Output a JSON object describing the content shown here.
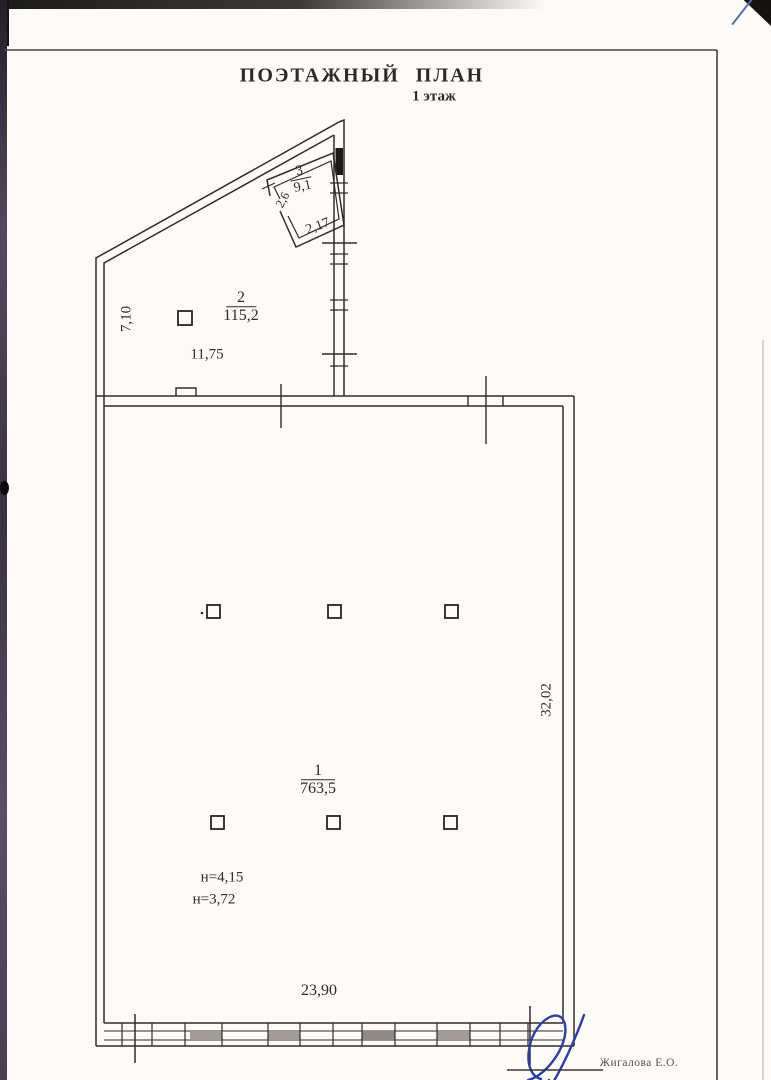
{
  "page": {
    "title": "ПОЭТАЖНЫЙ ПЛАН",
    "subtitle": "1 этаж"
  },
  "plan": {
    "room1": {
      "number": "1",
      "area": "763,5",
      "height_line1": "н=4,15",
      "height_line2": "н=3,72",
      "dim_right": "32,02",
      "dim_bottom": "23,90"
    },
    "room2": {
      "number": "2",
      "area": "115,2",
      "dim_left": "7,10",
      "dim_bottom": "11,75"
    },
    "room3": {
      "number": "3",
      "area": "9,1",
      "dim_side": "2,6",
      "dim_bottom": "2,17"
    }
  },
  "footer": {
    "examiner_name": "Жигалова Е.О."
  },
  "colors": {
    "ink": "#2e2b27",
    "paper": "#fcfbf8",
    "signature_blue": "#2e3f9f"
  }
}
